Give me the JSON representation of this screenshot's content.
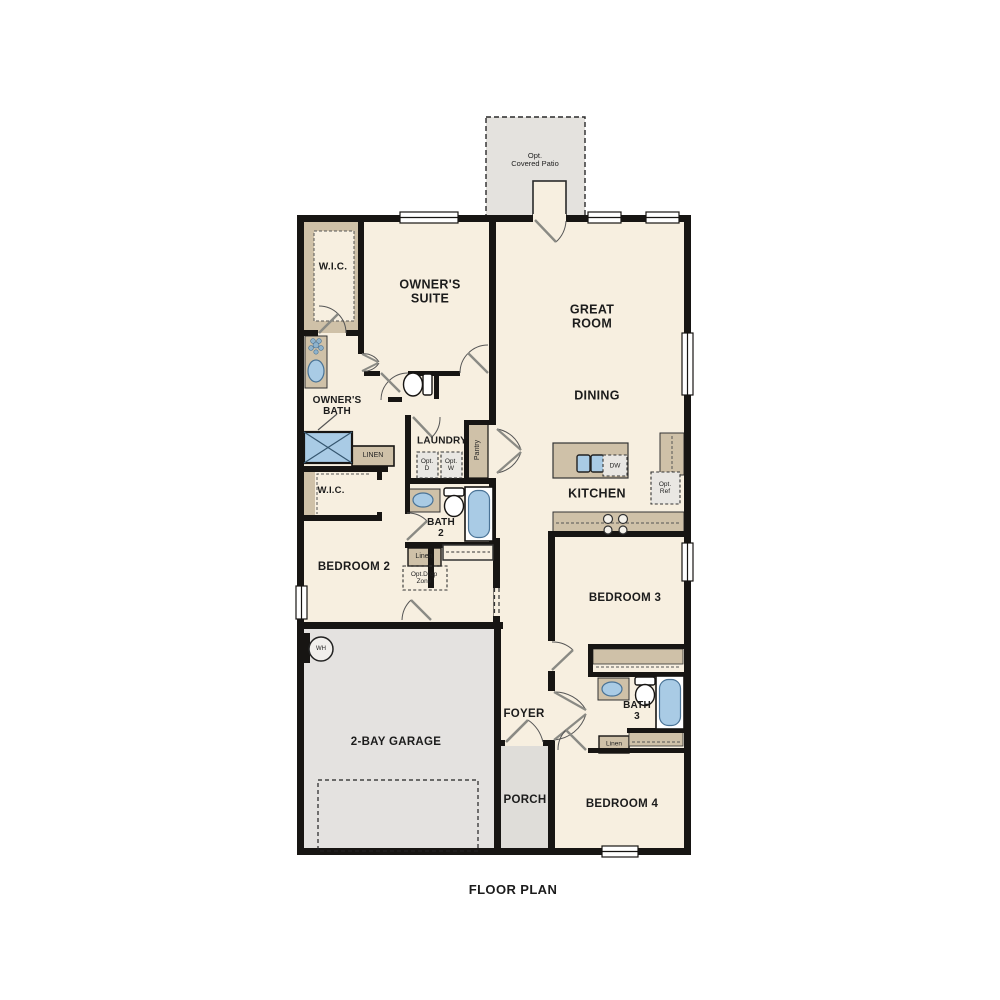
{
  "title": "FLOOR PLAN",
  "colors": {
    "floor": "#f7efe0",
    "tan": "#cfc1a8",
    "gray": "#e4e2de",
    "wall": "#171513",
    "fixture_blue": "#a9cbe5"
  },
  "rooms": {
    "patio": {
      "lines": [
        "Opt.",
        "Covered Patio"
      ]
    },
    "owners_suite": {
      "lines": [
        "OWNER'S",
        "SUITE"
      ]
    },
    "wic1": {
      "lines": [
        "W.I.C."
      ]
    },
    "owners_bath": {
      "lines": [
        "OWNER'S",
        "BATH"
      ]
    },
    "great_room": {
      "lines": [
        "GREAT",
        "ROOM"
      ]
    },
    "dining": {
      "lines": [
        "DINING"
      ]
    },
    "kitchen": {
      "lines": [
        "KITCHEN"
      ]
    },
    "laundry": {
      "lines": [
        "LAUNDRY"
      ]
    },
    "wic2": {
      "lines": [
        "W.I.C."
      ]
    },
    "bath2": {
      "lines": [
        "BATH",
        "2"
      ]
    },
    "bedroom2": {
      "lines": [
        "BEDROOM 2"
      ]
    },
    "bedroom3": {
      "lines": [
        "BEDROOM 3"
      ]
    },
    "bath3": {
      "lines": [
        "BATH",
        "3"
      ]
    },
    "bedroom4": {
      "lines": [
        "BEDROOM 4"
      ]
    },
    "foyer": {
      "lines": [
        "FOYER"
      ]
    },
    "porch": {
      "lines": [
        "PORCH"
      ]
    },
    "garage": {
      "lines": [
        "2-BAY GARAGE"
      ]
    }
  },
  "fixtures": {
    "linen1": "LINEN",
    "linen2": "Linen",
    "linen3": "Linen",
    "pantry": "Pantry",
    "opt_d": {
      "lines": [
        "Opt.",
        "D"
      ]
    },
    "opt_w": {
      "lines": [
        "Opt.",
        "W"
      ]
    },
    "dw": "DW",
    "opt_ref": {
      "lines": [
        "Opt.",
        "Ref"
      ]
    },
    "opt_drop": {
      "lines": [
        "Opt.Drop",
        "Zone"
      ]
    },
    "wh": "WH"
  }
}
